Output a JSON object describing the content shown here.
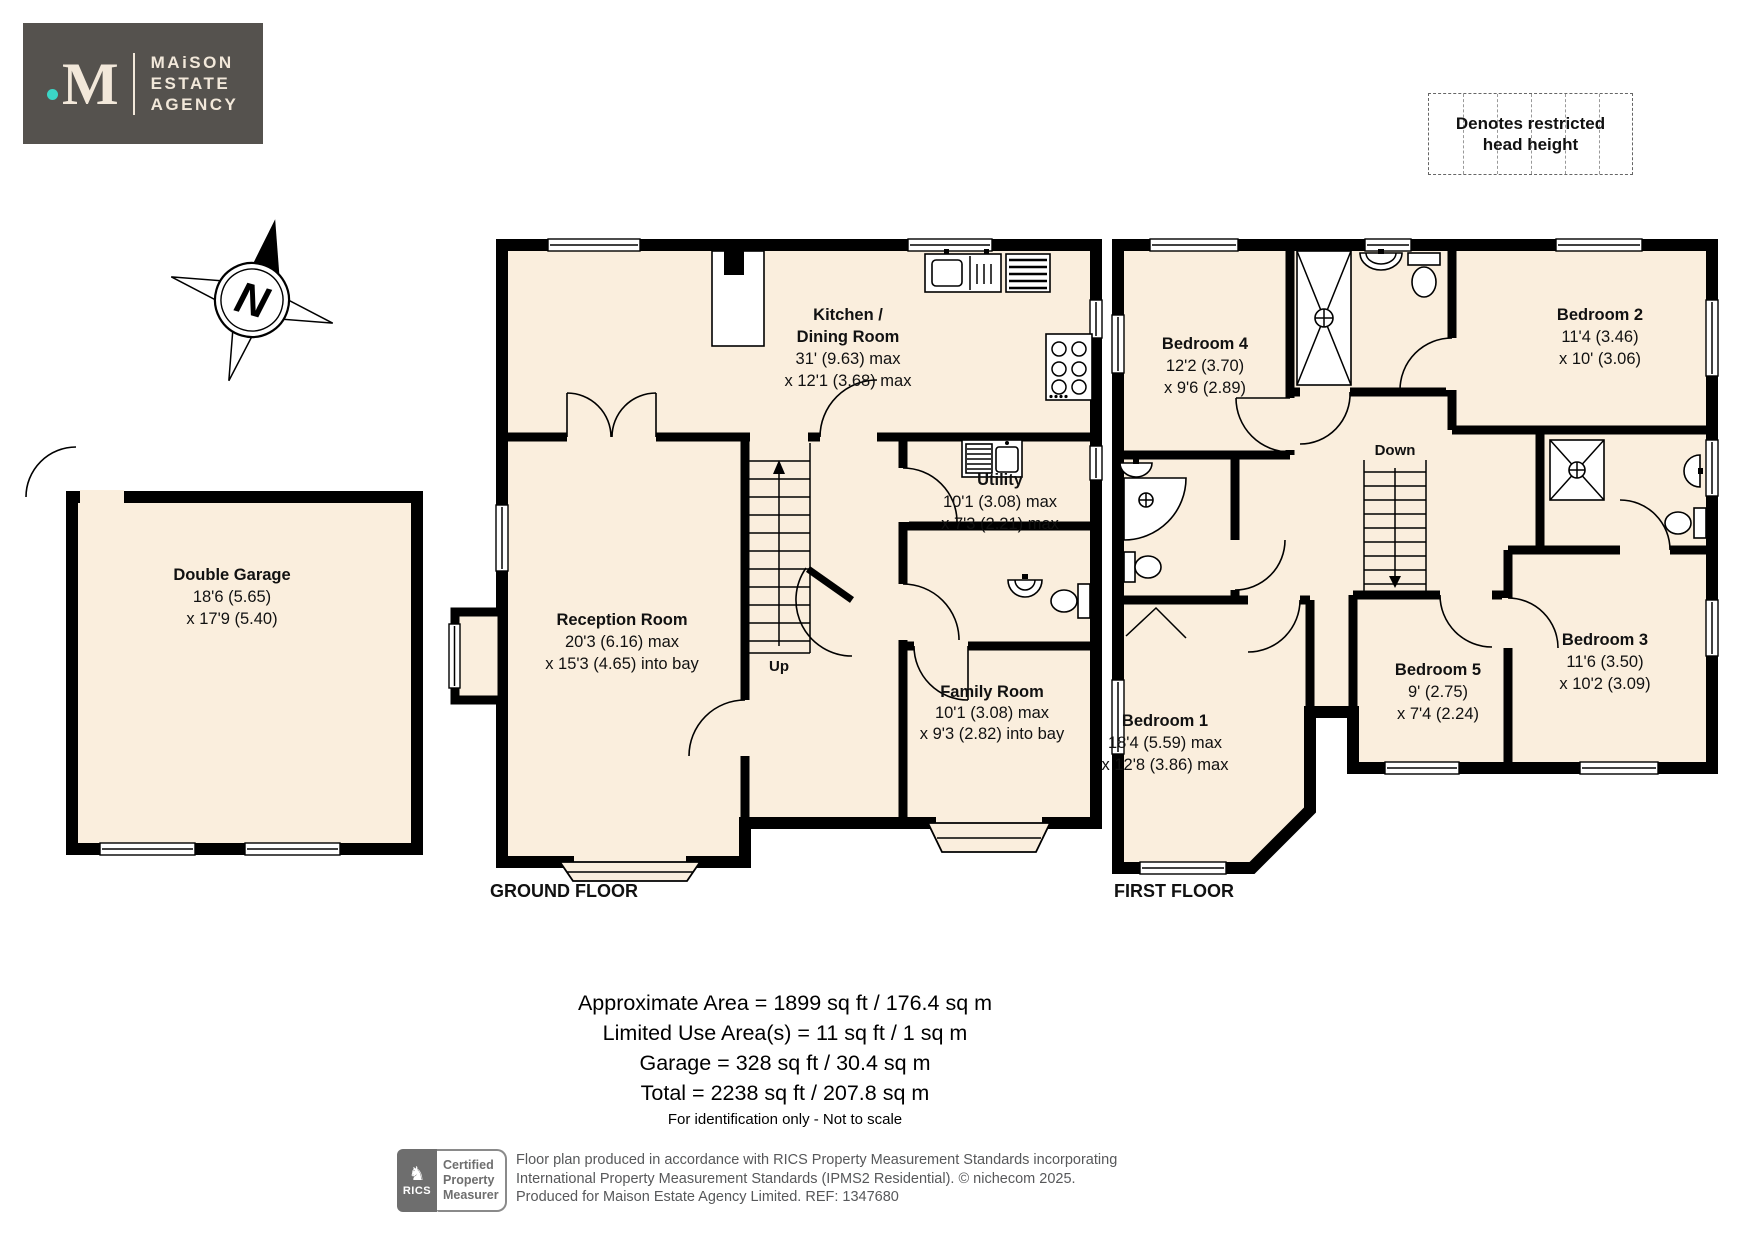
{
  "logo": {
    "dot": "",
    "monogram": "M",
    "lines": [
      "MAiSON",
      "ESTATE",
      "AGENCY"
    ]
  },
  "legend": {
    "line1": "Denotes restricted",
    "line2": "head height"
  },
  "compass": {
    "label": "N"
  },
  "floors": {
    "ground": {
      "title": "GROUND FLOOR",
      "rooms": {
        "kitchen": {
          "lines": [
            "Kitchen /",
            "Dining Room",
            "31' (9.63) max",
            "x 12'1 (3.68) max"
          ]
        },
        "reception": {
          "lines": [
            "Reception Room",
            "20'3 (6.16) max",
            "x 15'3 (4.65) into bay"
          ]
        },
        "utility": {
          "lines": [
            "Utility",
            "10'1 (3.08) max",
            "x 7'3 (2.21) max"
          ]
        },
        "family": {
          "lines": [
            "Family Room",
            "10'1 (3.08) max",
            "x 9'3 (2.82) into bay"
          ]
        },
        "up": "Up"
      }
    },
    "garage": {
      "lines": [
        "Double Garage",
        "18'6 (5.65)",
        "x 17'9 (5.40)"
      ]
    },
    "first": {
      "title": "FIRST FLOOR",
      "rooms": {
        "bedroom1": {
          "lines": [
            "Bedroom 1",
            "18'4 (5.59) max",
            "x 12'8 (3.86) max"
          ]
        },
        "bedroom2": {
          "lines": [
            "Bedroom 2",
            "11'4 (3.46)",
            "x 10' (3.06)"
          ]
        },
        "bedroom3": {
          "lines": [
            "Bedroom 3",
            "11'6 (3.50)",
            "x 10'2 (3.09)"
          ]
        },
        "bedroom4": {
          "lines": [
            "Bedroom 4",
            "12'2 (3.70)",
            "x 9'6 (2.89)"
          ]
        },
        "bedroom5": {
          "lines": [
            "Bedroom 5",
            "9' (2.75)",
            "x 7'4 (2.24)"
          ]
        },
        "down": "Down"
      }
    }
  },
  "summary": {
    "lines": [
      "Approximate Area = 1899 sq ft / 176.4 sq m",
      "Limited Use Area(s) = 11 sq ft / 1 sq m",
      "Garage = 328 sq ft / 30.4 sq m",
      "Total = 2238 sq ft / 207.8 sq m"
    ],
    "disclaimer": "For identification only - Not to scale"
  },
  "footer": {
    "rics": {
      "brand": "RICS",
      "cert_lines": [
        "Certified",
        "Property",
        "Measurer"
      ]
    },
    "fineprint": [
      "Floor plan produced in accordance with RICS Property Measurement Standards incorporating",
      "International Property Measurement Standards (IPMS2 Residential).   © nichecom 2025.",
      "Produced for Maison Estate Agency Limited.   REF: 1347680"
    ]
  },
  "colors": {
    "room_fill": "#FAEEDD",
    "wall": "#000000",
    "logo_bg": "#55524E",
    "logo_fg": "#F2E8DA",
    "accent_teal": "#3BD6C6",
    "fineprint_gray": "#57585A",
    "badge_gray": "#6E6E6E"
  }
}
